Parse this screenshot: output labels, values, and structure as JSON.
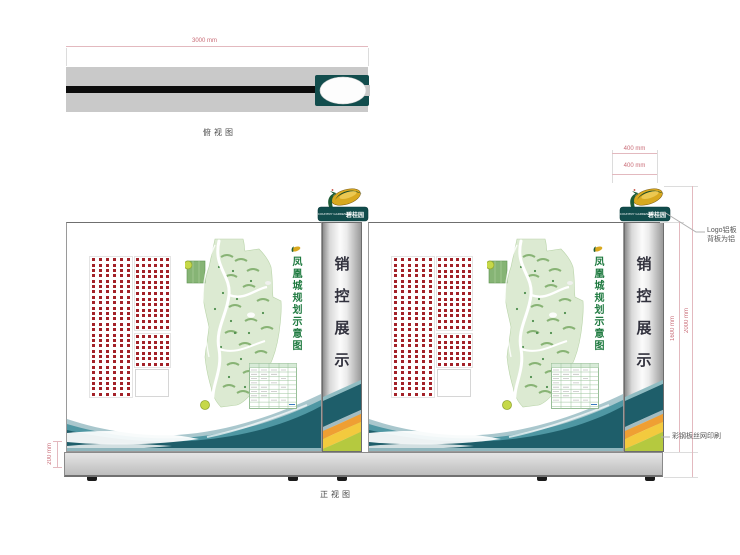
{
  "top_view": {
    "caption": "俯视图",
    "width_label": "3000 mm"
  },
  "front_view": {
    "caption": "正视图"
  },
  "board": {
    "pillar_chars": [
      "销",
      "控",
      "展",
      "示"
    ],
    "map_title": "凤凰城规划示意图",
    "logo": {
      "en": "COUNTRY GARDEN",
      "cn": "碧桂园"
    },
    "dot_grids": [
      {
        "rows": 26,
        "cols": 6
      },
      {
        "rows": 13,
        "cols": 6
      },
      {
        "rows": 6,
        "cols": 6
      }
    ]
  },
  "dimensions": {
    "logo_width": "400 mm",
    "logo_depth": "400 mm",
    "panel_height": "1600 mm",
    "total_height": "2000 mm",
    "base_height": "200 mm"
  },
  "annotations": {
    "logo_note": [
      "Logo铝板",
      "背板为铝"
    ],
    "stripe_note": "彩钢板丝网印刷"
  },
  "colors": {
    "dot_red": "#a32128",
    "teal_dark": "#1e5e6a",
    "teal_mid": "#4f97a3",
    "teal_light": "#a9c7cd",
    "orange": "#ef9f33",
    "yellow": "#f3ca3e",
    "lime": "#b5c93f",
    "map_green": "#7fae6b",
    "brand_teal": "#114c4c"
  }
}
